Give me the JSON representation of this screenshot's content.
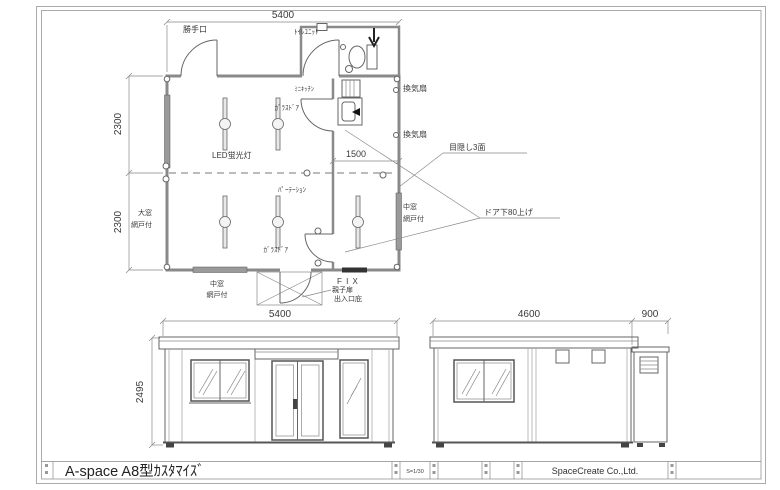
{
  "title_block": {
    "title": "A-space A8型ｶｽﾀﾏｲｽﾞ",
    "scale": "S=1/30",
    "company": "SpaceCreate Co.,Ltd."
  },
  "plan": {
    "dim_width": "5400",
    "dim_upper": "2300",
    "dim_lower": "2300",
    "dim_room": "1500",
    "back_door": "勝手口",
    "toilet_unit": "ﾄｲﾚﾕﾆｯﾄ",
    "vent_fan": "換気扇",
    "mini_kitchen": "ﾐﾆｷｯﾁﾝ",
    "glass_door": "ｶﾞﾗｽﾄﾞｱ",
    "led_light": "LED蛍光灯",
    "partition": "ﾊﾟｰﾃｰｼｮﾝ",
    "large_window": "大窓",
    "mid_window": "中窓",
    "screen_door": "網戸付",
    "privacy_screen": "目隠し3面",
    "door_raise": "ドア下80上げ",
    "fix": "F I X",
    "double_door": "親子扉",
    "entrance_canopy": "出入口庇"
  },
  "front_elevation": {
    "dim_width": "5400",
    "dim_height": "2495"
  },
  "side_elevation": {
    "dim_main": "4600",
    "dim_annex": "900"
  }
}
